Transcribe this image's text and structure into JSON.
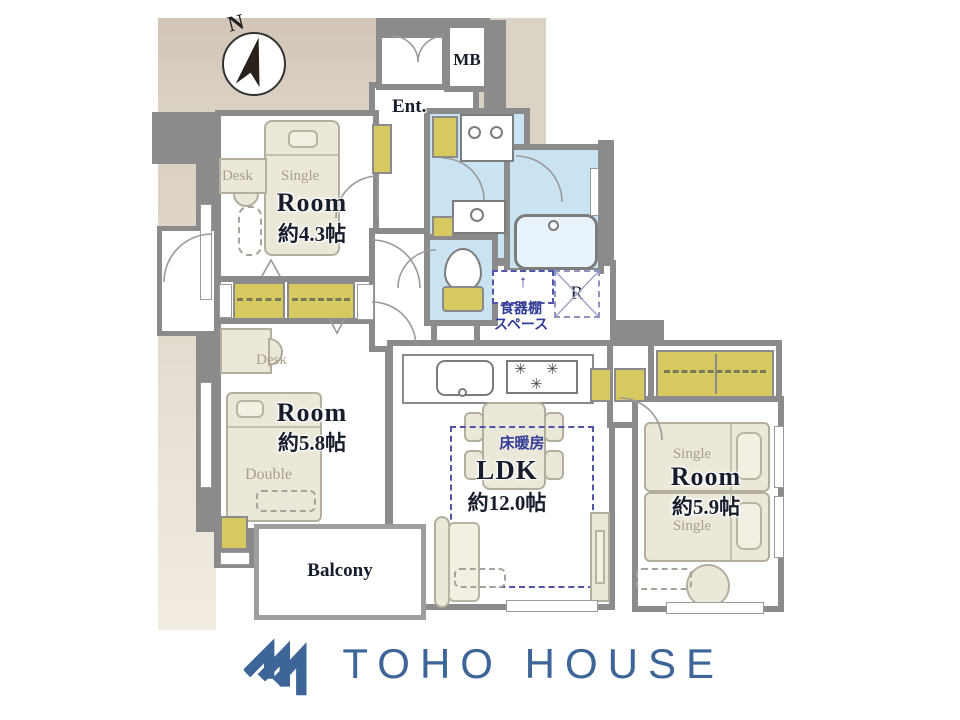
{
  "colors": {
    "wall": "#8b8b8b",
    "water_area": "#c9e3f2",
    "closet_yellow": "#d5c95f",
    "furniture_cream": "#ece8d9",
    "backdrop_beige": "#d4c8bb",
    "navy_text": "#333c97",
    "logo_blue": "#3e6598"
  },
  "compass": {
    "label": "N"
  },
  "plan": {
    "mb": "MB",
    "entrance": "Ent.",
    "refrigerator": "R",
    "balcony": "Balcony",
    "room1": {
      "name": "Room",
      "size": "約4.3帖",
      "bed": "Single",
      "desk": "Desk"
    },
    "room2": {
      "name": "Room",
      "size": "約5.8帖",
      "bed": "Double",
      "desk": "Desk"
    },
    "room3": {
      "name": "Room",
      "size": "約5.9帖",
      "bed_top": "Single",
      "bed_bottom": "Single"
    },
    "ldk": {
      "name": "LDK",
      "size": "約12.0帖",
      "floor_heating": "床暖房"
    },
    "cupboard": {
      "arrow": "↑",
      "line1": "食器棚",
      "line2": "スペース"
    },
    "icons": {
      "burner": "✳"
    }
  },
  "logo": {
    "text": "TOHO HOUSE"
  }
}
